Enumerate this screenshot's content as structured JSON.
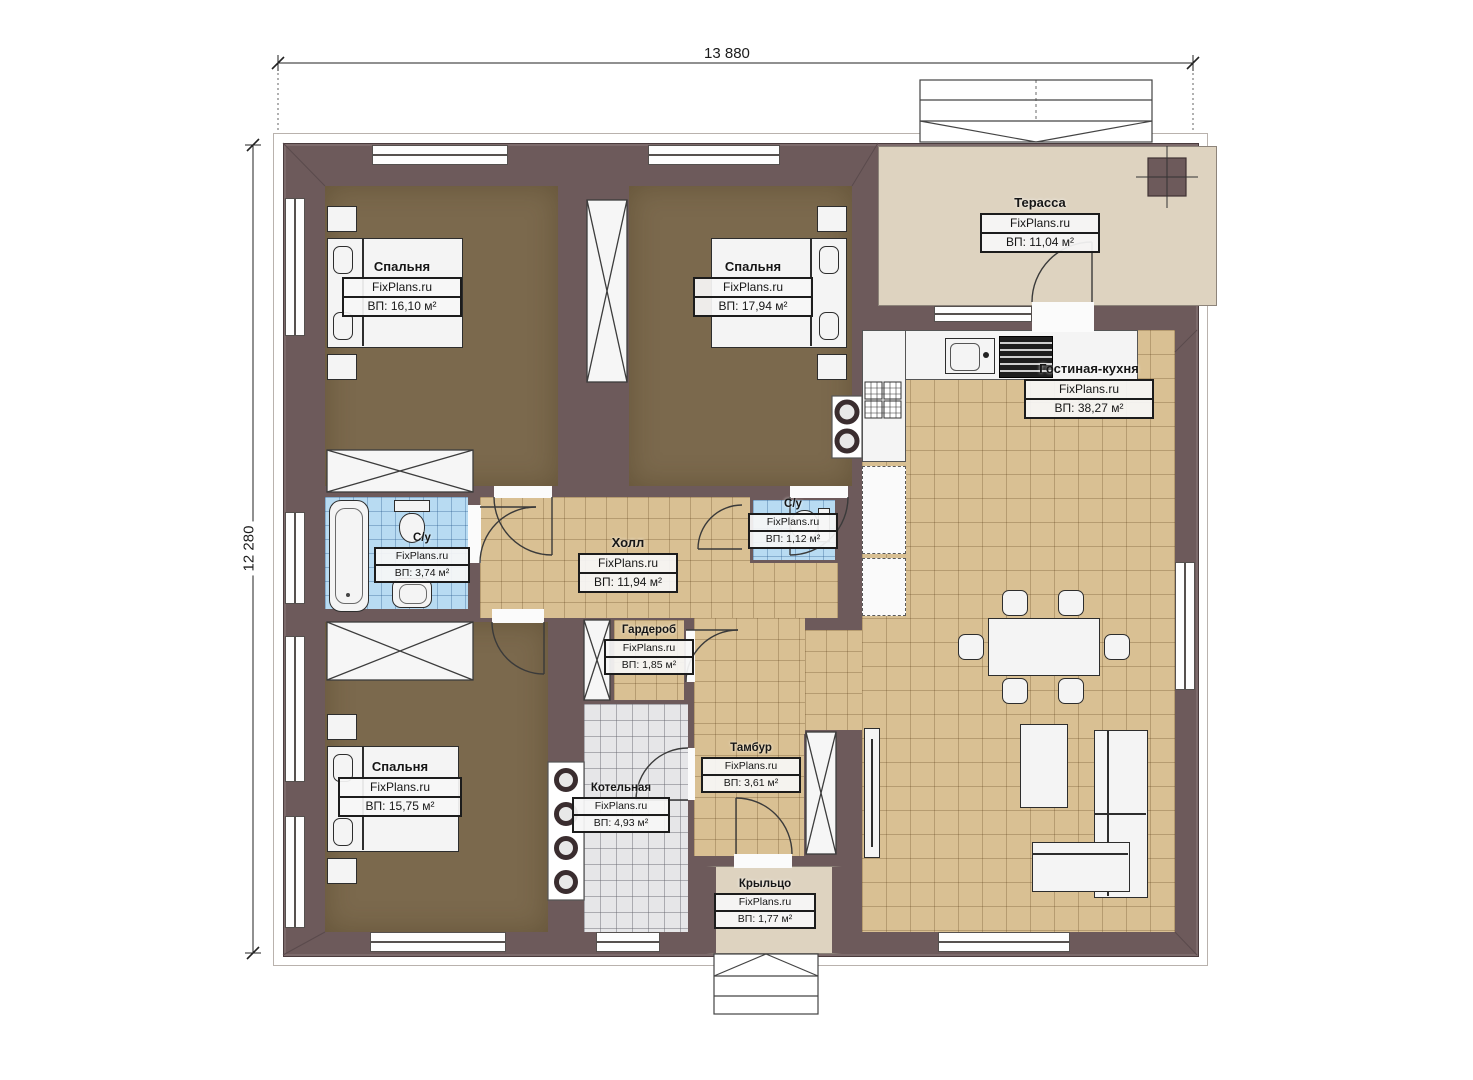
{
  "meta": {
    "watermark": "FixPlans.ru",
    "plan_type": "single-storey house floor plan"
  },
  "dimensions": {
    "width_mm": "13 880",
    "depth_mm": "12 280"
  },
  "colors": {
    "wall": "#6d5a5b",
    "bedroom_floor": "#7b694d",
    "tile_tan": "#d9c093",
    "tile_blue": "#b8dbf2",
    "tile_gray": "#e6e6e8",
    "terrace": "#ded3c0"
  },
  "rooms": [
    {
      "id": "bedroom-1",
      "name": "Спальня",
      "area": "ВП: 16,10 м²"
    },
    {
      "id": "bedroom-2",
      "name": "Спальня",
      "area": "ВП: 17,94 м²"
    },
    {
      "id": "terrace",
      "name": "Терасса",
      "area": "ВП: 11,04 м²"
    },
    {
      "id": "living-kitchen",
      "name": "Гостиная-кухня",
      "area": "ВП: 38,27 м²"
    },
    {
      "id": "bathroom",
      "name": "С/у",
      "area": "ВП: 3,74 м²"
    },
    {
      "id": "hall",
      "name": "Холл",
      "area": "ВП: 11,94 м²"
    },
    {
      "id": "wc",
      "name": "С/у",
      "area": "ВП: 1,12 м²"
    },
    {
      "id": "wardrobe",
      "name": "Гардероб",
      "area": "ВП: 1,85 м²"
    },
    {
      "id": "bedroom-3",
      "name": "Спальня",
      "area": "ВП: 15,75 м²"
    },
    {
      "id": "boiler-room",
      "name": "Котельная",
      "area": "ВП: 4,93 м²"
    },
    {
      "id": "vestibule",
      "name": "Тамбур",
      "area": "ВП: 3,61 м²"
    },
    {
      "id": "porch",
      "name": "Крыльцо",
      "area": "ВП: 1,77 м²"
    }
  ]
}
